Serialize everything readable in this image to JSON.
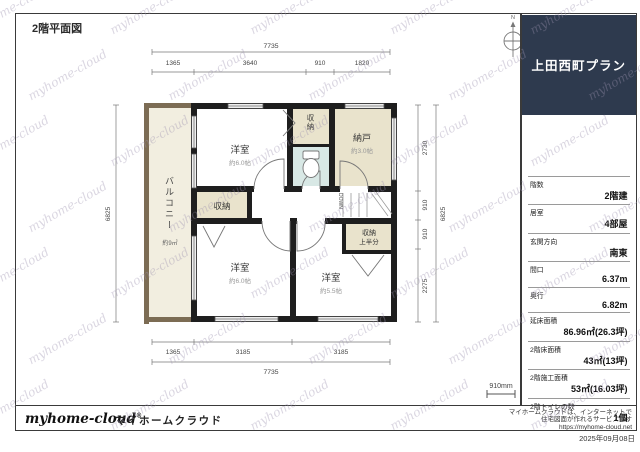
{
  "page": {
    "title_label": "2階平面図",
    "date": "2025年09月08日"
  },
  "plan_header": {
    "title": "上田西町プラン"
  },
  "sidebar": {
    "rows": [
      {
        "label": "階数",
        "value": "2階建"
      },
      {
        "label": "居室",
        "value": "4部屋"
      },
      {
        "label": "玄関方向",
        "value": "南東"
      },
      {
        "label": "間口",
        "value": "6.37m"
      },
      {
        "label": "奥行",
        "value": "6.82m"
      },
      {
        "label": "延床面積",
        "value": "86.96㎡(26.3坪)"
      },
      {
        "label": "2階床面積",
        "value": "43㎡(13坪)"
      },
      {
        "label": "2階施工面積",
        "value": "53㎡(16.03坪)"
      },
      {
        "label": "2階トイレの数",
        "value": "1個"
      }
    ]
  },
  "footer": {
    "logo_text": "myhome-cloud",
    "logo_mark": "®",
    "brand": "マイホームクラウド",
    "desc_line1": "マイホームクラウドは、インターネットで",
    "desc_line2": "住宅図面が作れるサービスです",
    "desc_line3": "https://myhome-cloud.net"
  },
  "compass": {
    "north_label": "N"
  },
  "scalebar": {
    "label": "910mm"
  },
  "watermark": {
    "text": "myhome-cloud"
  },
  "plan": {
    "rooms": {
      "room_top": {
        "name": "洋室",
        "size": "約6.0帖"
      },
      "room_bottom_left": {
        "name": "洋室",
        "size": "約6.0帖"
      },
      "room_bottom_right": {
        "name": "洋室",
        "size": "約5.5帖"
      },
      "nando": {
        "name": "納戸",
        "size": "約3.0帖"
      },
      "closet_top": {
        "name": "収納"
      },
      "closet_mid": {
        "name": "収納"
      },
      "closet_half": {
        "line1": "収納",
        "line2": "上半分"
      },
      "balcony": {
        "name": "バルコニー",
        "size": "約9㎡"
      }
    },
    "stairs_label": "DOWN",
    "dims": {
      "top_total": "7735",
      "top_segments": [
        "1365",
        "3640",
        "910",
        "1820"
      ],
      "bottom_total": "7735",
      "bottom_segments": [
        "1365",
        "3185",
        "3185"
      ],
      "left_total": "6825",
      "right_total": "6825",
      "right_segments": [
        "2730",
        "910",
        "910",
        "2275"
      ]
    },
    "colors": {
      "wall": "#1e1e1e",
      "closet_fill": "#e9e3cc",
      "toilet_fill": "#d8e8e5",
      "balcony_fill": "#f2eee0",
      "balcony_wall": "#7c6c54",
      "header_navy": "#2e3a4e"
    }
  }
}
